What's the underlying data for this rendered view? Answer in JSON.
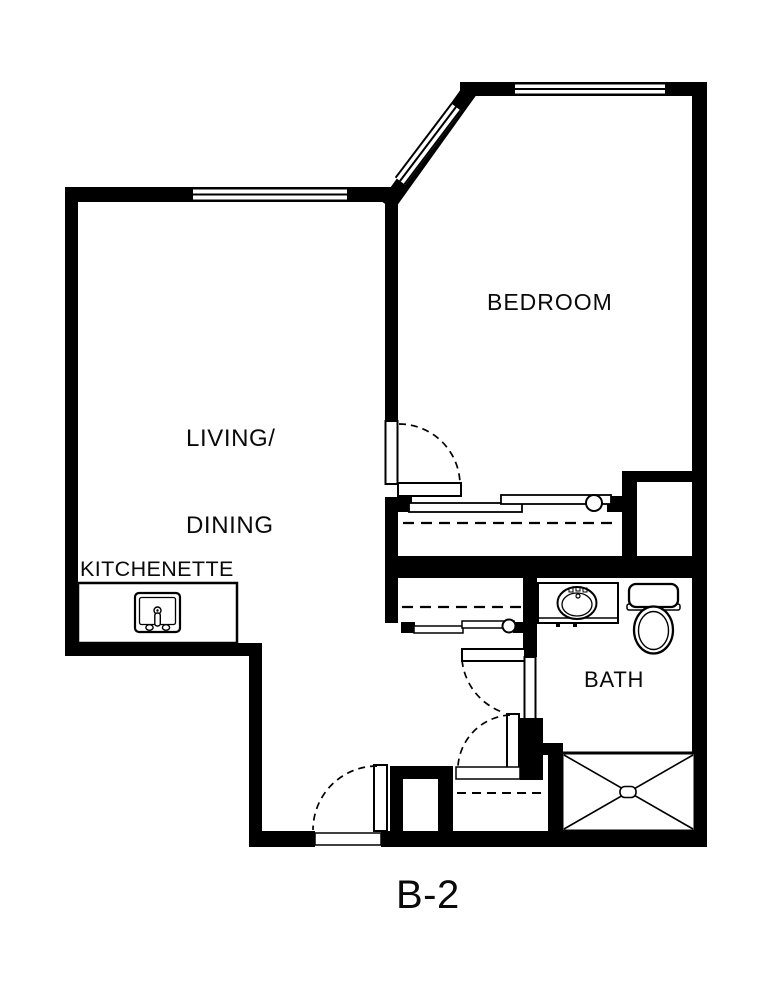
{
  "plan": {
    "unit_label": "B-2",
    "rooms": {
      "living_dining": {
        "line1": "LIVING/",
        "line2": "DINING"
      },
      "bedroom": {
        "label": "BEDROOM"
      },
      "kitchenette": {
        "label": "KITCHENETTE"
      },
      "bath": {
        "label": "BATH"
      }
    },
    "fixtures": [
      {
        "name": "kitchen-sink-icon"
      },
      {
        "name": "bathroom-sink-icon"
      },
      {
        "name": "toilet-icon"
      },
      {
        "name": "shower-icon"
      }
    ],
    "symbols": [
      {
        "name": "window-symbol",
        "style": "double-line band in wall"
      },
      {
        "name": "door-swing-arc",
        "style": "dashed quarter circle"
      },
      {
        "name": "closet-shelf-line",
        "style": "dashed line"
      },
      {
        "name": "sliding-door-symbol",
        "style": "offset bars with round pull"
      }
    ],
    "colors": {
      "wall": "#000000",
      "background": "#ffffff",
      "line": "#0a0a0a"
    }
  }
}
